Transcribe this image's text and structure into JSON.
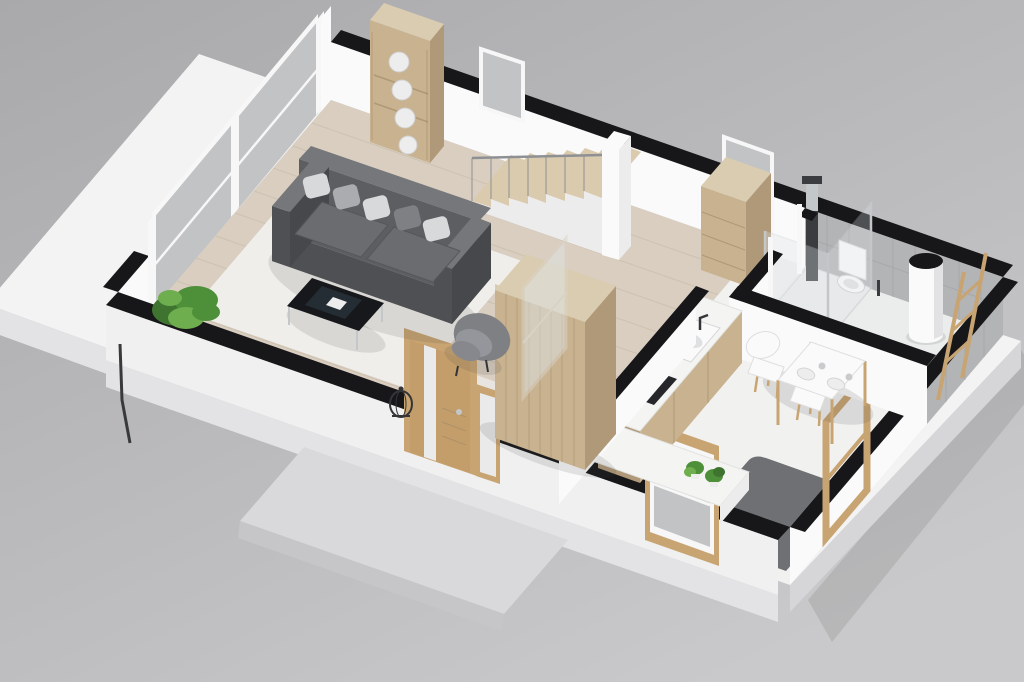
{
  "meta": {
    "image_type": "3d-floor-plan-render",
    "projection": "isometric-cutaway",
    "visible_text": "none",
    "walls_cut_style": "black-top-bands"
  },
  "palette": {
    "bg1": "#a9a9ab",
    "bg2": "#c9c9cb",
    "slab": "#f3f3f4",
    "slabSide": "#e3e3e5",
    "slabSide2": "#d6d6d8",
    "porch": "#d9d9db",
    "porchSide": "#c6c6c8",
    "woodFloor": "#d9cec0",
    "woodLine": "#c4b7a3",
    "entryFloor": "#e9e7e3",
    "roomFloor": "#f1f1f0",
    "bathFloor": "#ebecec",
    "rug": "#efeeea",
    "darkFloor": "#6f7073",
    "wallWhite": "#fafafa",
    "wallExt": "#f0f0f1",
    "wallTop": "#17171a",
    "white2": "#ececed",
    "tile": "#b3b4b6",
    "tileLine": "#a3a4a6",
    "glass": "#c2c3c5",
    "glassPane": "#dfe4e7",
    "frameWhite": "#f7f7f7",
    "frameWood": "#c8a472",
    "oakFront": "#c8b290",
    "oakSide": "#b09979",
    "oakTop": "#daccb1",
    "oakDark": "#9d8765",
    "doorWood": "#c49e6a",
    "frost": "#eaeaea",
    "sofa": "#5c5e62",
    "sofaFront": "#4e5054",
    "sofaSide": "#46484c",
    "sofaCushion": "#6a6c70",
    "sofaTop": "#75777b",
    "pillowLight": "#d8d9db",
    "pillowMid": "#aaacb0",
    "pillowDark": "#7e8084",
    "chairGray": "#7e8084",
    "chairGray2": "#94969b",
    "chairSeat": "#86888d",
    "tableDark": "#17181c",
    "tableSheen": "#33424c",
    "chrome": "#c3c7ca",
    "railing": "#8e9094",
    "stairWood": "#dbcbae",
    "showerDark": "#3a3c3f",
    "counterTop": "#f4f4f3",
    "sinkInner": "#dfe0e2",
    "cooktop": "#26272a",
    "plantDark": "#3f7330",
    "plant": "#4e8f3a",
    "plantLight": "#6fae4e",
    "plate": "#ededee",
    "cup": "#c9cbcd",
    "dark": "#343538",
    "shadow": "rgba(60,60,60,0.13)"
  },
  "rooms": [
    {
      "name": "living-room",
      "floor": "light wood planks",
      "items": [
        "dark gray tufted sofa with 5 pillows",
        "black glass coffee table",
        "gray armchair",
        "white area rug",
        "corner plant",
        "wood shelf with 4 decorative plates",
        "wire floor lantern"
      ]
    },
    {
      "name": "hallway",
      "floor": "wood / pale tile at entry",
      "items": [
        "staircase 7 wood treads",
        "white newel column",
        "tall wooden wardrobe",
        "sliding glass panel",
        "wooden console cabinet",
        "glass exit door frame"
      ]
    },
    {
      "name": "kitchen-dining",
      "floor": "white with dark gray work zone",
      "items": [
        "wood-front counter with white sink",
        "dark cooktop",
        "counter along front wall with 2 plants",
        "wood framed window",
        "white dining table set for two",
        "2 white chairs with wood legs"
      ]
    },
    {
      "name": "bathroom",
      "floor": "light gray",
      "items": [
        "glass shower with dark column",
        "wall-hung toilet",
        "toilet brush",
        "white cylinder water heater",
        "wooden towel ladder",
        "gray tiled walls"
      ]
    },
    {
      "name": "exterior",
      "items": [
        "white terrace slab",
        "concrete porch step",
        "wood front door with frosted glass",
        "frosted sidelight",
        "downspout at west corner"
      ]
    }
  ],
  "counts": {
    "stair_steps": 7,
    "shelf_plates": 4,
    "sofa_pillows": 5,
    "dining_chairs": 2,
    "left_wall_window_panels": 2,
    "kitchen_plants": 2
  }
}
